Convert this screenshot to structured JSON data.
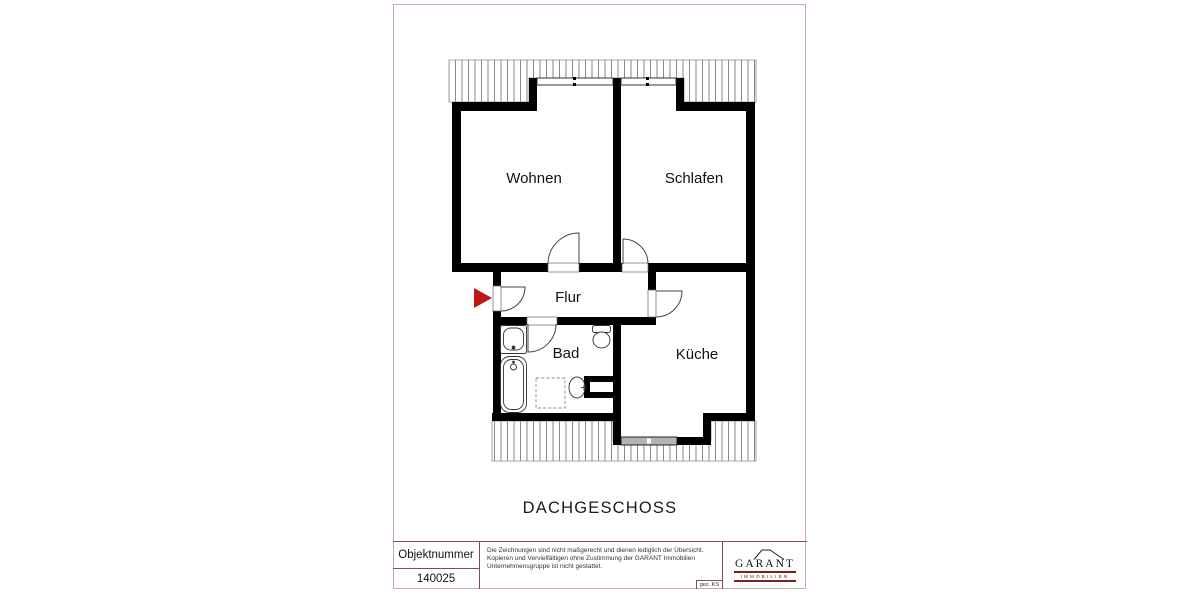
{
  "page": {
    "floor_title": "DACHGESCHOSS"
  },
  "plan": {
    "rooms": {
      "wohnen": "Wohnen",
      "schlafen": "Schlafen",
      "flur": "Flur",
      "bad": "Bad",
      "kueche": "Küche"
    }
  },
  "title_block": {
    "object_number_label": "Objektnummer",
    "object_number_value": "140025",
    "disclaimer_lines": [
      "Die Zeichnungen sind nicht maßgerecht und dienen lediglich der Übersicht.",
      "Kopieren und Vervielfältigen ohne Zustimmung der GARANT Immobilien",
      "Unternehmensgruppe ist nicht gestattet."
    ],
    "signature": "gez. KS",
    "logo": {
      "brand": "GARANT",
      "tagline": "IMMOBILIEN"
    }
  },
  "colors": {
    "wall": "#000000",
    "entrance_arrow": "#c01818",
    "logo_rule": "#7d1f1f",
    "page_border": "#d2a8a8",
    "window_sill": "#b4b4b4"
  }
}
